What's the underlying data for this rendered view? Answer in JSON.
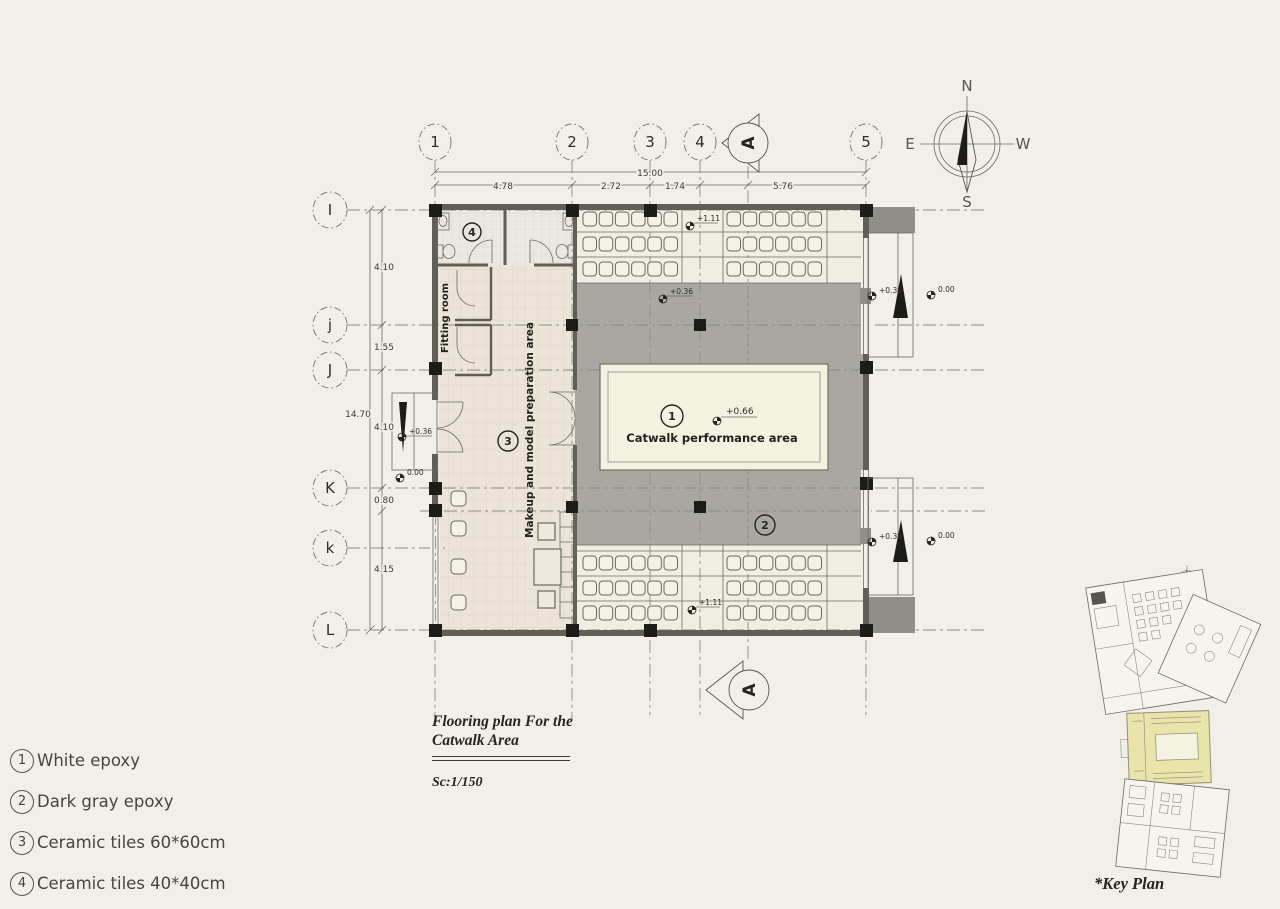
{
  "colors": {
    "background": "#f1efe7",
    "dark_gray_epoxy": "#a8a7a1",
    "catwalk_fill": "#f3f1e0",
    "keyplan_highlight": "#eae4ab",
    "wall": "#5f5f58"
  },
  "legend": {
    "items": [
      {
        "num": "1",
        "label": "White epoxy"
      },
      {
        "num": "2",
        "label": "Dark gray epoxy"
      },
      {
        "num": "3",
        "label": "Ceramic tiles 60*60cm"
      },
      {
        "num": "4",
        "label": "Ceramic tiles 40*40cm"
      }
    ]
  },
  "title_block": {
    "line1": "Flooring  plan For the",
    "line2": "Catwalk Area",
    "scale": "Sc:1/150"
  },
  "key_plan": {
    "label": "*Key Plan"
  },
  "compass": {
    "north": "N",
    "south": "S",
    "east": "E",
    "west": "W"
  },
  "grid": {
    "cols": [
      "1",
      "2",
      "3",
      "4",
      "5"
    ],
    "rows": [
      "I",
      "j",
      "J",
      "K",
      "k",
      "L"
    ],
    "section_label": "A"
  },
  "dims": {
    "total_width": "15.00",
    "top_spans": [
      "4.78",
      "2.72",
      "1.74",
      "5.76"
    ],
    "left_spans": [
      "4.10",
      "1.55",
      "4.10",
      "0.80",
      "4.15"
    ],
    "left_total": "14.70"
  },
  "levels": {
    "seating_top": "+1.11",
    "seating_bottom": "+1.11",
    "gray_area": "+0.36",
    "catwalk": "+0.66",
    "right_top_inner": "+0.36",
    "right_top_outer": "0.00",
    "right_bottom_inner": "+0.36",
    "right_bottom_outer": "0.00",
    "left_ramp_inner": "+0.36",
    "left_ramp_outer": "0.00"
  },
  "rooms": {
    "catwalk": "Catwalk performance area",
    "makeup": "Makeup and model preparation area",
    "fitting": "Fitting room"
  },
  "tags": {
    "catwalk": "1",
    "dark_gray": "2",
    "makeup": "3",
    "toilet": "4"
  }
}
